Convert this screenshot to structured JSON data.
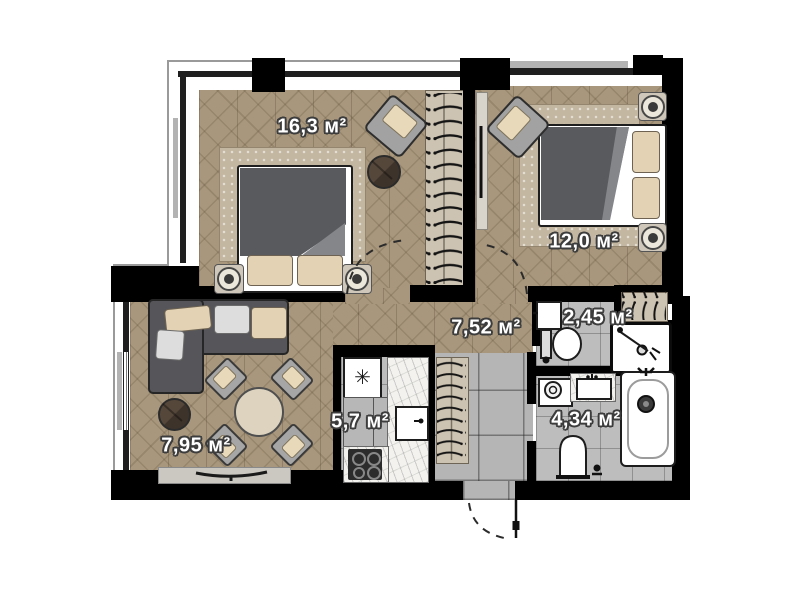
{
  "rooms": [
    {
      "id": "bedroom-1",
      "area_label": "16,3 м²"
    },
    {
      "id": "bedroom-2",
      "area_label": "12,0 м²"
    },
    {
      "id": "hallway",
      "area_label": "7,52 м²"
    },
    {
      "id": "wc",
      "area_label": "2,45 м²"
    },
    {
      "id": "kitchen",
      "area_label": "5,7 м²"
    },
    {
      "id": "bathroom",
      "area_label": "4,34 м²"
    },
    {
      "id": "living-room",
      "area_label": "7,95 м²"
    }
  ],
  "icons": {
    "fridge_symbol": "✳"
  },
  "colors": {
    "wall": "#000000",
    "wood_floor": "#a8977c",
    "tile_floor": "#b5b5b5",
    "rug": "#c4b7a1",
    "furniture_dark": "#58585a",
    "pillow_beige": "#e3d3b4",
    "closet_beige": "#cdc3b2"
  }
}
